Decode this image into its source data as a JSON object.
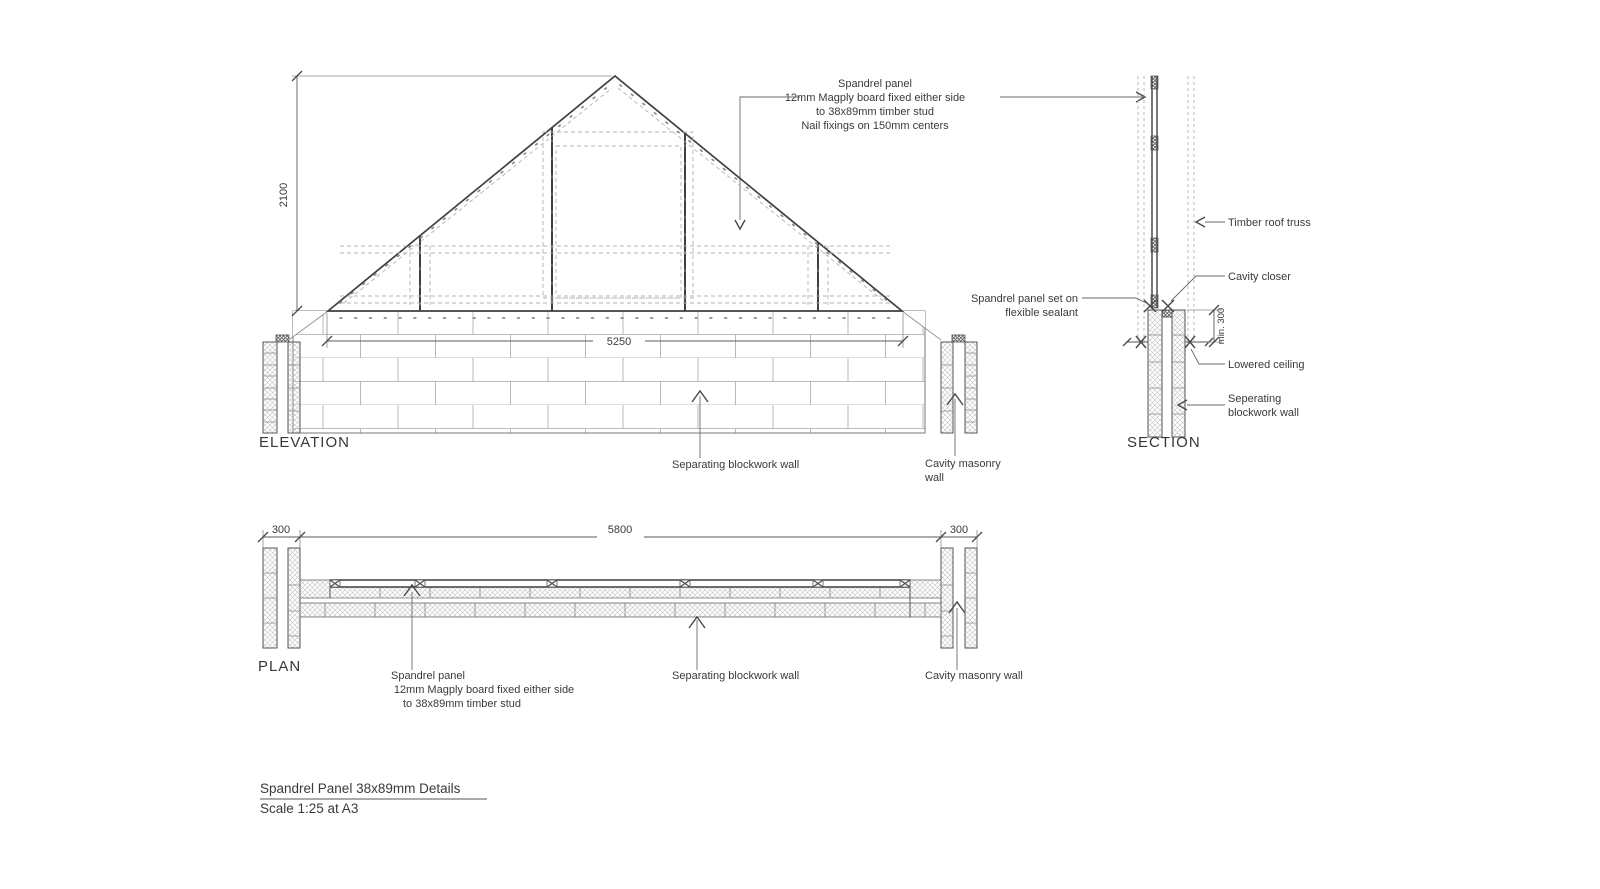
{
  "palette": {
    "ink": "#3f3f3f",
    "ink-text": "#3a3a3a",
    "light": "#b3b3b3"
  },
  "top_note": {
    "line1": "Spandrel panel",
    "line2": "12mm Magply board fixed either side",
    "line3": "to 38x89mm timber stud",
    "line4": "Nail fixings on 150mm centers"
  },
  "elevation": {
    "title": "ELEVATION",
    "dim_height": "2100",
    "dim_width": "5250",
    "separating_label": "Separating blockwork wall",
    "cavity_label_1": "Cavity masonry",
    "cavity_label_2": "wall"
  },
  "section": {
    "title": "SECTION",
    "truss_label": "Timber roof truss",
    "closer_label": "Cavity closer",
    "sealant_label_1": "Spandrel panel set on",
    "sealant_label_2": "flexible sealant",
    "dim_min": "min. 300",
    "ceiling_label": "Lowered ceiling",
    "separating_label_1": "Seperating",
    "separating_label_2": "blockwork wall"
  },
  "plan": {
    "title": "PLAN",
    "dim_left": "300",
    "dim_main": "5800",
    "dim_right": "300",
    "spandrel_label_1": "Spandrel panel",
    "spandrel_label_2": "12mm Magply board fixed either side",
    "spandrel_label_3": "to 38x89mm timber stud",
    "separating_label": "Separating blockwork wall",
    "cavity_label": "Cavity masonry wall"
  },
  "titleblock": {
    "title": "Spandrel Panel 38x89mm Details",
    "scale": "Scale 1:25 at A3"
  }
}
